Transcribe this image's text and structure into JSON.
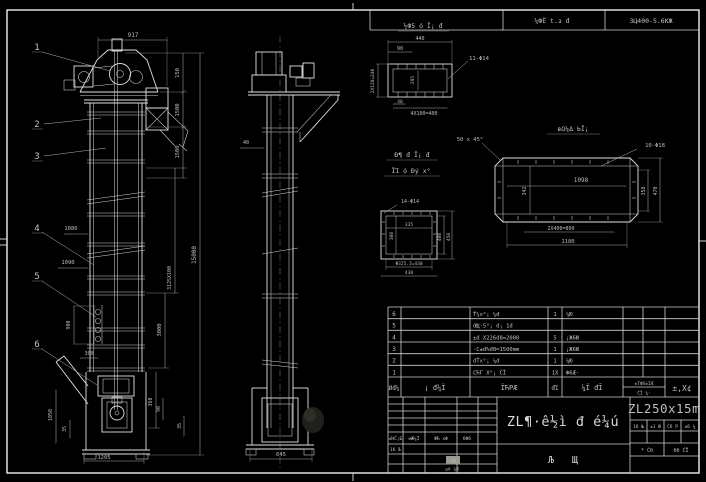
{
  "colors": {
    "background": "#000000",
    "line": "#e2e2e2",
    "dim_text": "#bdbdbd",
    "highlight": "#9a9a8c"
  },
  "top_strip": {
    "cell1": "¼ФЁ t.з đ",
    "cell2": "3Ц400-5.6КЖ"
  },
  "front_view": {
    "callouts": [
      "1",
      "2",
      "3",
      "4",
      "5",
      "6"
    ],
    "dims": {
      "top_width": "917",
      "right_chain": [
        "150",
        "1500",
        "1500"
      ],
      "overall_height": "15000",
      "mid_sections": "3125X100",
      "lower": "3000",
      "boot_right_chain": "360",
      "left_upper_1": "1086",
      "left_upper_2": "1090",
      "left_mid": "900",
      "left_small": "300",
      "boot_left_1": "1050",
      "boot_left_2": "35",
      "bottom_width": "1205",
      "boot_r1": "90",
      "boot_r2": "35"
    }
  },
  "side_view": {
    "dims": {
      "upper": "40",
      "base_width": "645"
    }
  },
  "detail_top": {
    "title": "½Ф5 ó Ī¡ đ",
    "dims": {
      "width": "440",
      "offset": "90",
      "holes": "11-Φ14",
      "left": "2X120=240",
      "inner": "295",
      "small": "40",
      "pitch": "4X100=400"
    }
  },
  "detail_right": {
    "title": "вΩ¼Δ ЬĪ¡",
    "chamfer": "50 x 45°",
    "holes": "10-Φ18",
    "dims": {
      "inner_width": "1098",
      "inner_height": "342",
      "right_inner": "358",
      "right_outer": "470",
      "pitch": "2X400=800",
      "bottom_width": "1180"
    }
  },
  "detail_square": {
    "title_line1": "Đ¶ đ Ī¡ đ",
    "title_line2": "ĪΊ ó Đý x°",
    "holes": "14-Φ14",
    "dims": {
      "inner_width": "335",
      "inner_height": "300",
      "right_inner": "400",
      "right_outer": "450",
      "bottom1": "Φ325.3=430",
      "bottom2": "430"
    }
  },
  "bom": {
    "headers": {
      "seq": "Øđ¼",
      "code": "¡ đ¼Ϊ",
      "name": "ΪЋРÆ",
      "qty": "đΊ",
      "material": "¼Ϊ đĪ",
      "weight": "±TФX±ΊÆ",
      "weight_total": "ĆΪ ¼·",
      "remark": "±,X¢"
    },
    "rows": [
      {
        "seq": "6",
        "name": "Ť¼x°¡ ¼đ",
        "qty": "1",
        "material": "¼Ю"
      },
      {
        "seq": "5",
        "name": "đЩ·5°¡ đ¡ 1đ",
        "qty": "",
        "material": ""
      },
      {
        "seq": "4",
        "name": "±đ X226đ8=2000",
        "qty": "5",
        "material": "¡Ж6Ю"
      },
      {
        "seq": "3",
        "name": "·C±đ%đ8=1500mm",
        "qty": "1",
        "material": "¡Ж6Ю"
      },
      {
        "seq": "2",
        "name": "đŤx°¡ ¼đ",
        "qty": "1",
        "material": "¼Ю"
      },
      {
        "seq": "1",
        "name": "СЋГ X°¡ ĆΪ",
        "qty": "1X",
        "material": "Ф6Æ·"
      }
    ]
  },
  "title_block": {
    "drawing_title": "ZL¶·ê½ì đ é¼ú",
    "drawing_subtitle": "Љ Щ",
    "model": "ZL250x15m",
    "left_row": [
      "±ΉĆ¡Б",
      "мЖ¼Ϊ",
      "ФЋ xФ",
      "бФб"
    ],
    "left_row2": "1б Љ",
    "highlight_cell": "Ćб",
    "left_bottom": "џõ ¼đ",
    "right_row": [
      "1б №",
      "±1 Ю",
      "Ćб Р",
      "±б ¼"
    ],
    "right_row2": [
      "* Ćб",
      "бб ĆΪ"
    ]
  }
}
